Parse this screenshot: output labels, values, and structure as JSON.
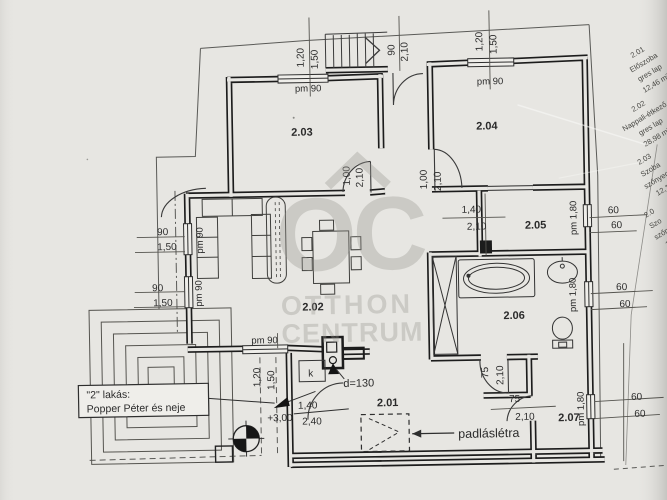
{
  "watermark": {
    "logo": "OC",
    "line1": "OTTHON",
    "line2": "CENTRUM"
  },
  "rooms": {
    "r201": "2.01",
    "r202": "2.02",
    "r203": "2.03",
    "r204": "2.04",
    "r205": "2.05",
    "r206": "2.06",
    "r207": "2.07"
  },
  "dims": {
    "v90": "90",
    "v120": "1,20",
    "v150": "1,50",
    "v210": "2,10",
    "v100": "1,00",
    "v140": "1,40",
    "v240": "2,40",
    "v60": "60",
    "v75": "75",
    "level": "+3,00",
    "pm90": "pm 90",
    "pm180": "pm 1,80"
  },
  "labels": {
    "flat_line1": "\"2\" lakás:",
    "flat_line2": "Popper Péter és neje",
    "attic_ladder": "padláslétra",
    "chimney_diameter": "d=130",
    "flue": "k"
  },
  "schedule": [
    {
      "number": "2.01",
      "name": "Előszoba",
      "finish": "gres lap",
      "area": "12,46 m²"
    },
    {
      "number": "2.02",
      "name": "Nappali-étkező",
      "finish": "gres lap",
      "area": "28,98 m²"
    },
    {
      "number": "2.03",
      "name": "Szoba",
      "finish": "szőnyeg",
      "area": "12,1"
    },
    {
      "number": "2.0",
      "name": "Szo",
      "finish": "szőn",
      "area": "1"
    }
  ],
  "colors": {
    "paper": "#e7e6e2",
    "ink": "#1c1c1c",
    "thin": "#5a5a57",
    "watermark": "#97968f"
  }
}
